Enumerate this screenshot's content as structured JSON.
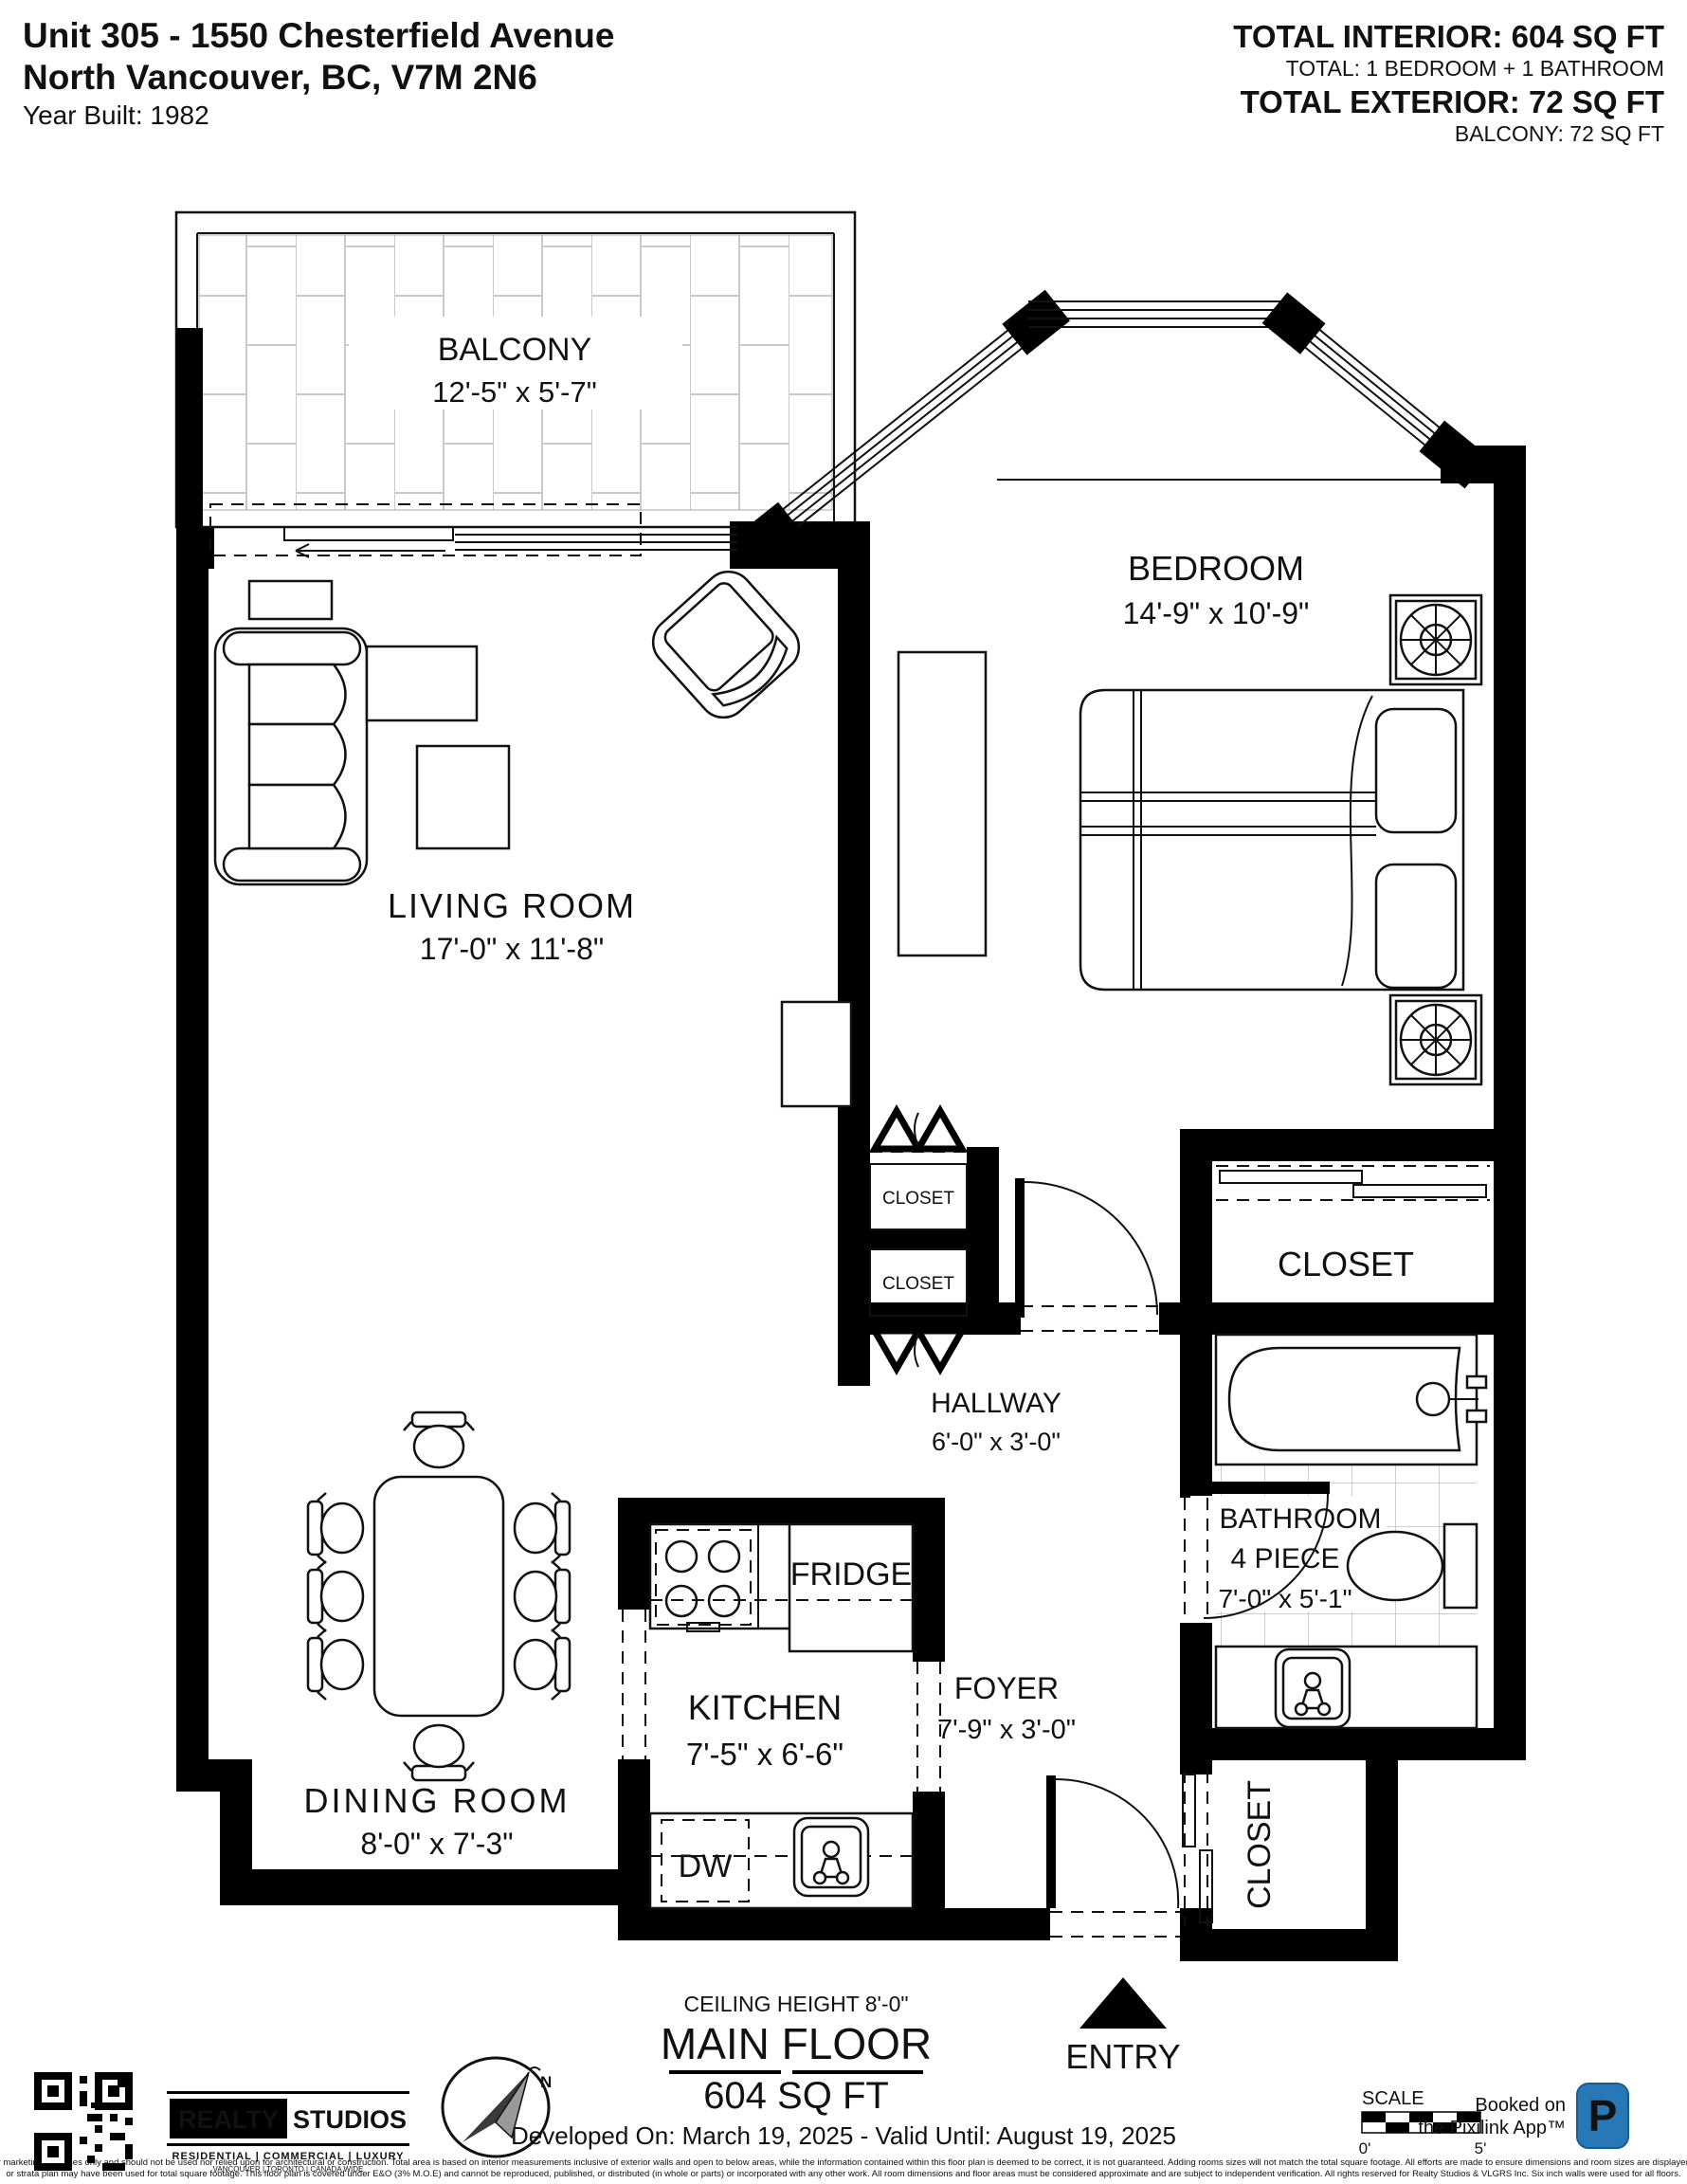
{
  "header": {
    "address_line1": "Unit 305 - 1550 Chesterfield Avenue",
    "address_line2": "North Vancouver, BC, V7M 2N6",
    "year_built": "Year Built: 1982",
    "total_interior": "TOTAL INTERIOR: 604 SQ FT",
    "total_interior_sub": "TOTAL: 1 BEDROOM + 1 BATHROOM",
    "total_exterior": "TOTAL EXTERIOR: 72 SQ FT",
    "total_exterior_sub": "BALCONY: 72 SQ FT"
  },
  "rooms": {
    "balcony": {
      "name": "BALCONY",
      "dims": "12'-5\" x 5'-7\""
    },
    "bedroom": {
      "name": "BEDROOM",
      "dims": "14'-9\" x 10'-9\""
    },
    "living_room": {
      "name": "LIVING ROOM",
      "dims": "17'-0\" x 11'-8\""
    },
    "dining_room": {
      "name": "DINING ROOM",
      "dims": "8'-0\" x 7'-3\""
    },
    "kitchen": {
      "name": "KITCHEN",
      "dims": "7'-5\" x 6'-6\""
    },
    "hallway": {
      "name": "HALLWAY",
      "dims": "6'-0\" x 3'-0\""
    },
    "foyer": {
      "name": "FOYER",
      "dims": "7'-9\" x 3'-0\""
    },
    "bathroom": {
      "name": "BATHROOM",
      "type": "4 PIECE",
      "dims": "7'-0\" x 5'-1\""
    },
    "closet_bedroom_1": "CLOSET",
    "closet_bedroom_2": "CLOSET",
    "closet_walkin": "CLOSET",
    "closet_entry": "CLOSET",
    "fridge": "FRIDGE",
    "dishwasher": "DW",
    "entry": "ENTRY"
  },
  "plan_notes": {
    "ceiling_height": "CEILING HEIGHT 8'-0\"",
    "floor_name": "MAIN FLOOR",
    "floor_area": "604 SQ FT"
  },
  "footer": {
    "validity": "Developed On: March 19, 2025 - Valid Until: August 19, 2025",
    "disclaimer_line1": "This floor plan is intended for marketing purposes only and should not be used nor relied upon for architectural or construction. Total area is based on interior measurements inclusive of exterior walls and open to below areas, while the information contained within this floor plan is deemed to be correct, it is not guaranteed. Adding rooms sizes will not match the total square footage. All efforts are made to ensure dimensions and room sizes are displayed accurately. BC Assessment",
    "disclaimer_line2": "or strata plan may have been used for total square footage. This floor plan is covered under E&O (3% M.O.E) and cannot be reproduced, published, or distributed (in whole or parts) or incorporated with any other work. All room dimensions and floor areas must be considered approximate and are subject to independent verification. All rights reserved for Realty Studios & VLGRS Inc. Six inch walls were used for all floors.",
    "brand": {
      "realty": "REALTY",
      "studios": "STUDIOS",
      "tagline": "RESIDENTIAL | COMMERCIAL | LUXURY",
      "cities": "VANCOUVER | TORONTO | CANADA WIDE"
    },
    "scale": {
      "label": "SCALE",
      "start": "0'",
      "end": "5'"
    },
    "pixilink": {
      "line1": "Booked on",
      "line2": "the Pixilink App™",
      "badge_letter": "P",
      "badge_color": "#2878b8"
    }
  },
  "colors": {
    "wall": "#000000",
    "tile_line": "#c9c9c9",
    "fine_print": "#a8a8a8"
  }
}
